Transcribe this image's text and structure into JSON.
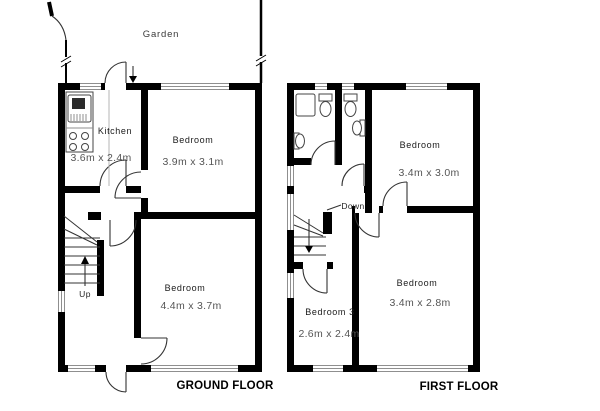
{
  "colors": {
    "wall": "#000000",
    "room_text": "#1a1a1a",
    "dim_text": "#555555",
    "title_text": "#000000",
    "window_line": "#8f8f8f",
    "door_line": "#333333"
  },
  "garden": {
    "label": "Garden"
  },
  "ground_floor": {
    "title": "GROUND FLOOR",
    "stairs_label": "Up",
    "kitchen": {
      "name": "Kitchen",
      "dims": "3.6m x 2.4m"
    },
    "bedroom_front": {
      "name": "Bedroom",
      "dims": "3.9m x 3.1m"
    },
    "bedroom_back": {
      "name": "Bedroom",
      "dims": "4.4m x 3.7m"
    }
  },
  "first_floor": {
    "title": "FIRST FLOOR",
    "stairs_label": "Down",
    "bedroom_front": {
      "name": "Bedroom",
      "dims": "3.4m x 3.0m"
    },
    "bedroom_back": {
      "name": "Bedroom",
      "dims": "3.4m x 2.8m"
    },
    "bedroom_three": {
      "name": "Bedroom 3",
      "dims": "2.6m x 2.4m"
    }
  }
}
